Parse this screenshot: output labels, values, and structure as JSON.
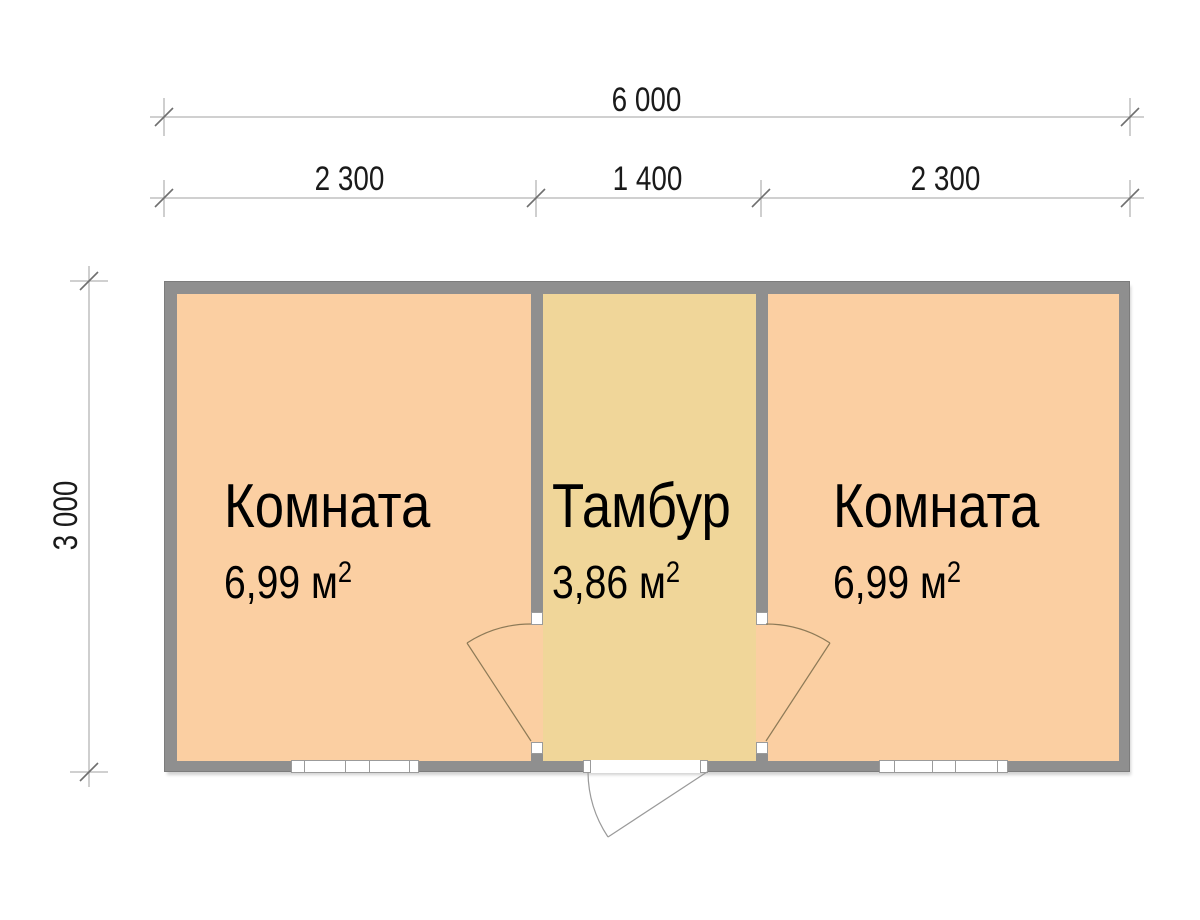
{
  "plan": {
    "type": "floor-plan",
    "dimensions": {
      "total_width": "6 000",
      "segment_left": "2 300",
      "segment_middle": "1 400",
      "segment_right": "2 300",
      "height": "3 000"
    },
    "rooms": {
      "left": {
        "name": "Комната",
        "area_text": "6,99 м",
        "area_sup": "2"
      },
      "middle": {
        "name": "Тамбур",
        "area_text": "3,86 м",
        "area_sup": "2"
      },
      "right": {
        "name": "Комната",
        "area_text": "6,99 м",
        "area_sup": "2"
      }
    },
    "colors": {
      "room_fill": "#fbcfa2",
      "vestibule_fill": "#f0d699",
      "wall": "#8f8f8f",
      "dimension_line": "#b5b5b5",
      "tick_slash": "#6f6f6f",
      "door_line": "#8d7a57",
      "text": "#000000"
    }
  }
}
